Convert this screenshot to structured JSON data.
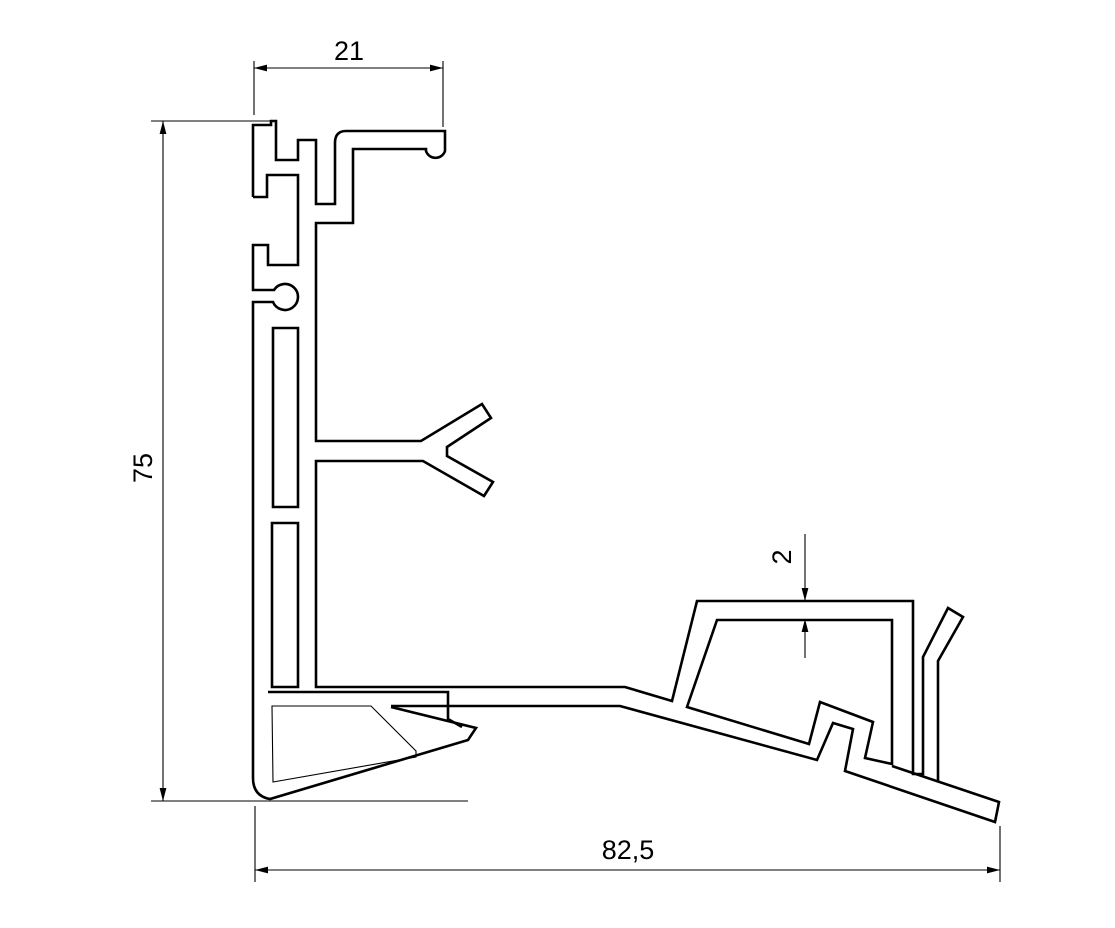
{
  "page": {
    "background": "#ffffff",
    "line_color": "#000000"
  },
  "drawing": {
    "type": "technical-cross-section",
    "description": "Aluminium extrusion profile cross-section line drawing with linear dimensions",
    "dimensions": [
      {
        "id": "top-width",
        "label": "21",
        "orientation": "horizontal"
      },
      {
        "id": "left-height",
        "label": "75",
        "orientation": "vertical"
      },
      {
        "id": "wall-thickness",
        "label": "2",
        "orientation": "vertical"
      },
      {
        "id": "bottom-width",
        "label": "82,5",
        "orientation": "horizontal"
      }
    ]
  }
}
